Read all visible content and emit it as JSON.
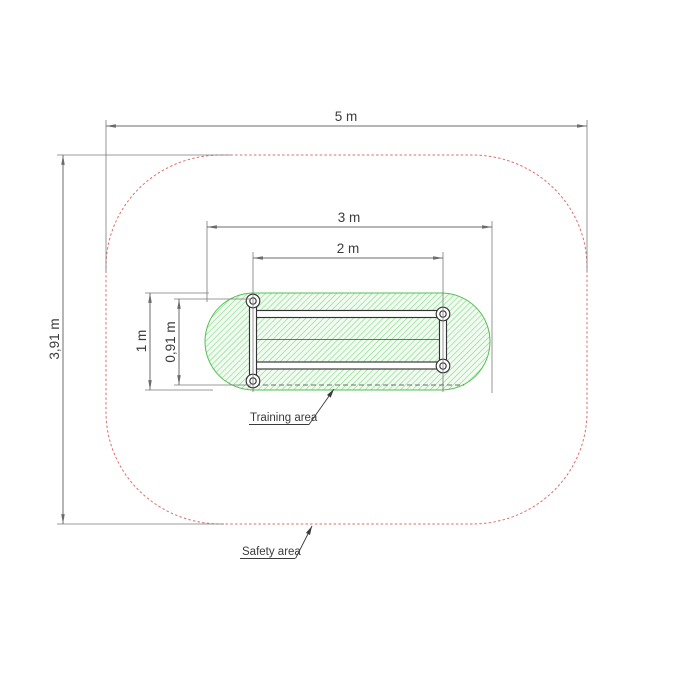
{
  "dimensions": {
    "total_width": "5 m",
    "total_height": "3,91 m",
    "training_width": "3 m",
    "equipment_width": "2 m",
    "training_height": "1 m",
    "equipment_height": "0,91 m"
  },
  "labels": {
    "training_area": "Training area",
    "safety_area": "Safety area"
  },
  "colors": {
    "background": "#ffffff",
    "safety_outline": "#d9706a",
    "training_outline": "#52c152",
    "training_hatch": "#7fd87f",
    "training_fill": "#f1fbf1",
    "dimension_line": "#6b6b6b",
    "equipment_line": "#333333",
    "text": "#3b3b3b"
  }
}
